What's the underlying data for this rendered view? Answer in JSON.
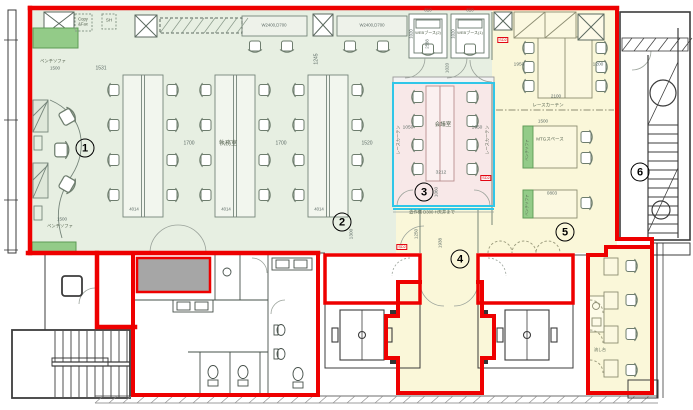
{
  "rooms": {
    "office": "執務室",
    "meeting": "会議室",
    "mtg_space": "MTGスペース",
    "web_booth_1": "WEBブース(1)",
    "web_booth_2": "WEBブース(2)",
    "copy_fax": "Copy &Fax",
    "sh": "SH",
    "bench_sofa": "ベンチソファ",
    "lace_curtain": "レースカーテン",
    "shelf_note": "造作棚 D300 H天井まで",
    "sink": "流し台"
  },
  "dims": {
    "d1531": "1531",
    "d1245": "1245",
    "d1700": "1700",
    "d1520": "1520",
    "d4014": "4014",
    "d1300": "1300",
    "wall_desk": "W2400,D700",
    "d810": "810",
    "d1020": "1020",
    "d2588": "2588",
    "d1950": "1950",
    "d1200": "1200",
    "d2100": "2100",
    "d1500": "1500",
    "d0803": "0803",
    "d1050": "1050",
    "d3212": "3212",
    "d1060": "1060",
    "d1250": "1250",
    "d1938": "1938"
  },
  "tags": {
    "door": "SD2"
  },
  "markers": [
    {
      "n": "1"
    },
    {
      "n": "2"
    },
    {
      "n": "3"
    },
    {
      "n": "4"
    },
    {
      "n": "5"
    },
    {
      "n": "6"
    }
  ],
  "colors": {
    "tenant_outline": "#ee0000",
    "office_zone": "#e7efe2",
    "common_zone": "#faf7d9",
    "meeting_zone": "#f8e8e8",
    "highlight_cyan": "#30c6e8",
    "shaft_gray": "#a6a6a6",
    "planter_green": "#93cb88"
  }
}
